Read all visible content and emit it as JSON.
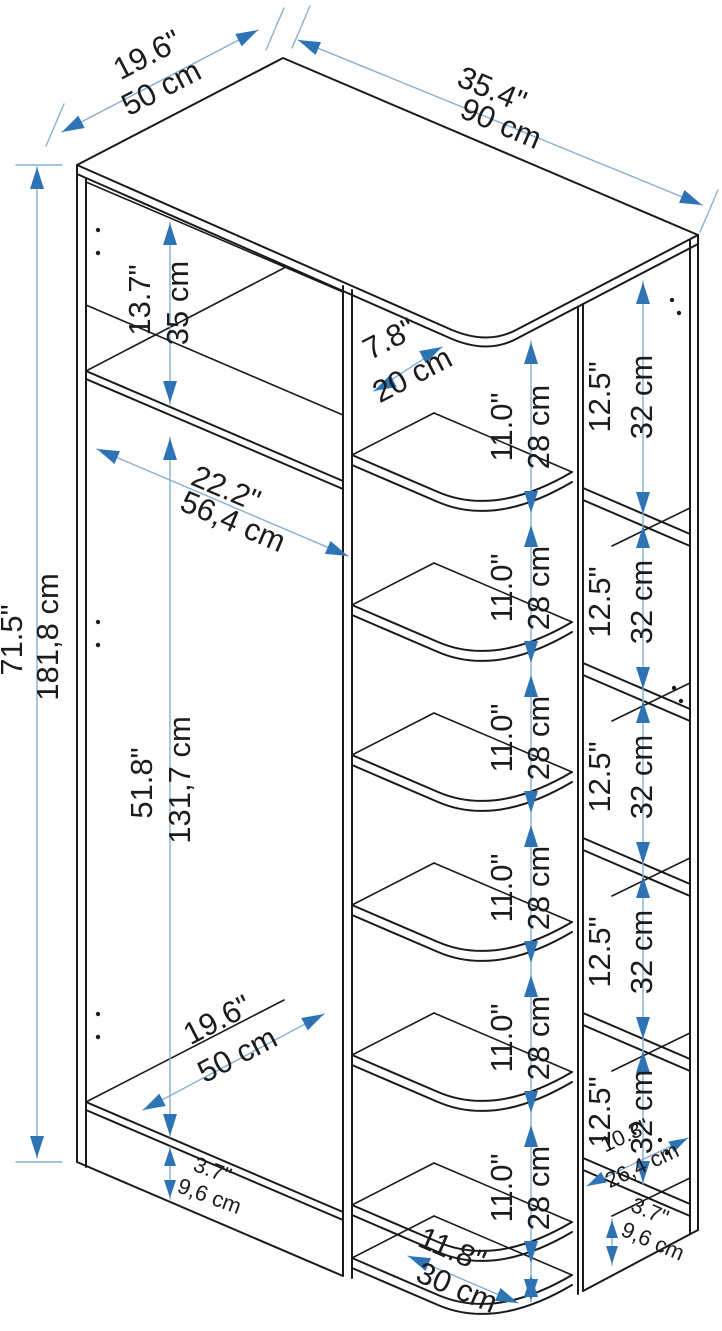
{
  "colors": {
    "outline": "#1a1a1a",
    "dimension_line": "#86afd4",
    "arrow": "#2e74b5",
    "label_text": "#1c1c1c"
  },
  "dimensions": {
    "top_depth": {
      "inch": "19.6\"",
      "cm": "50 cm"
    },
    "top_width": {
      "inch": "35.4\"",
      "cm": "90 cm"
    },
    "upper_section_height": {
      "inch": "13.7\"",
      "cm": "35 cm"
    },
    "interior_width": {
      "inch": "22.2\"",
      "cm": "56,4 cm"
    },
    "total_height": {
      "inch": "71.5\"",
      "cm": "181,8 cm"
    },
    "hanging_height": {
      "inch": "51.8\"",
      "cm": "131,7 cm"
    },
    "shelf_depth": {
      "inch": "7.8\"",
      "cm": "20 cm"
    },
    "middle_shelf_spacing": {
      "inch": "11.0\"",
      "cm": "28 cm"
    },
    "side_shelf_spacing": {
      "inch": "12.5\"",
      "cm": "32 cm"
    },
    "bottom_depth": {
      "inch": "19.6\"",
      "cm": "50 cm"
    },
    "left_plinth_height": {
      "inch": "3.7\"",
      "cm": "9,6 cm"
    },
    "bottom_shelf_width": {
      "inch": "11.8\"",
      "cm": "30 cm"
    },
    "side_shelf_width": {
      "inch": "10.3\"",
      "cm": "26,4 cm"
    },
    "right_plinth_height": {
      "inch": "3.7\"",
      "cm": "9,6 cm"
    }
  }
}
